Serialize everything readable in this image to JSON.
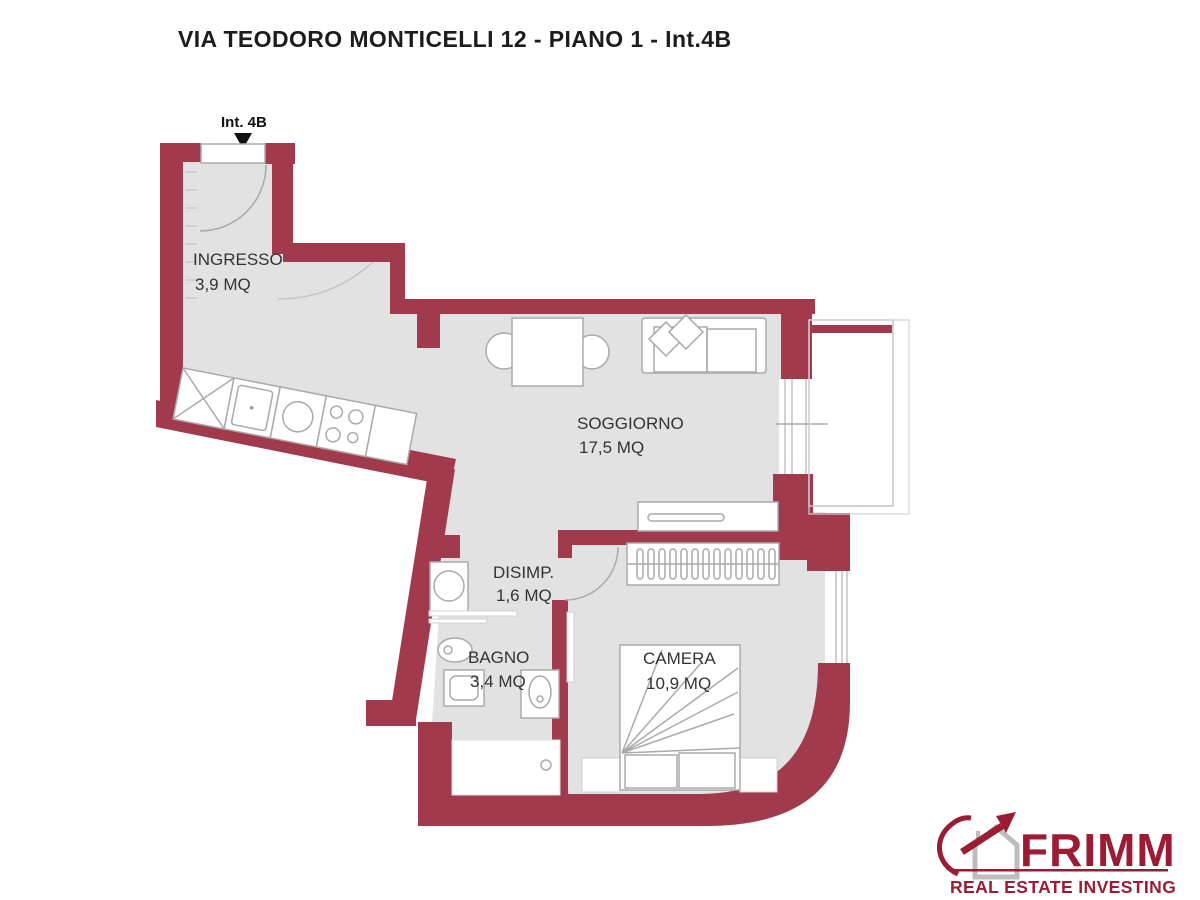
{
  "title": "VIA TEODORO MONTICELLI 12 - PIANO 1 - Int.4B",
  "floorplan": {
    "entrance_label": "Int. 4B",
    "rooms": [
      {
        "name": "INGRESSO",
        "area": "3,9 MQ"
      },
      {
        "name": "SOGGIORNO",
        "area": "17,5 MQ"
      },
      {
        "name": "DISIMP.",
        "area": "1,6 MQ"
      },
      {
        "name": "BAGNO",
        "area": "3,4 MQ"
      },
      {
        "name": "CAMERA",
        "area": "10,9 MQ"
      }
    ]
  },
  "logo": {
    "brand": "FRIMM",
    "tagline": "REAL ESTATE INVESTING"
  },
  "colors": {
    "wall": "#A23A4D",
    "floor": "#E2E2E2",
    "logo_red": "#9C1C33",
    "furniture_line": "#AAAAAA"
  }
}
